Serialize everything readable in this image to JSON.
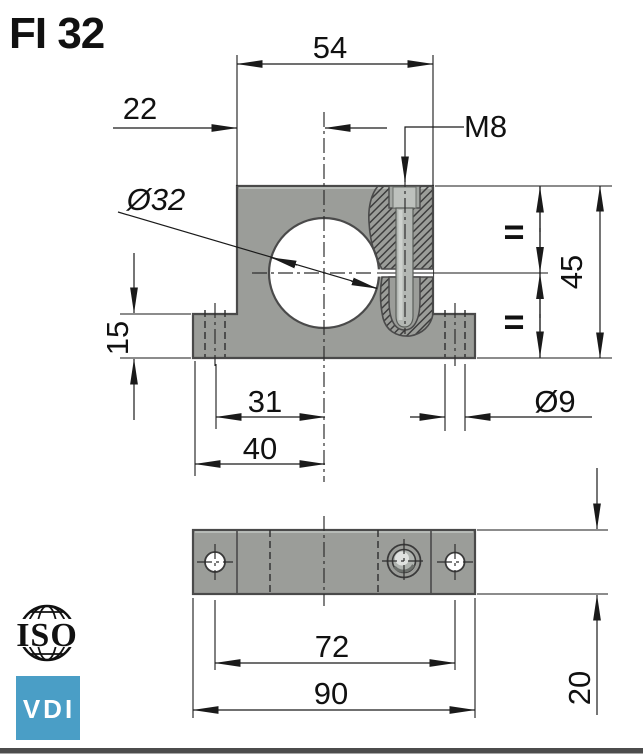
{
  "title": "FI 32",
  "front_view": {
    "width_top": "54",
    "center_offset": "22",
    "thread_label": "M8",
    "bore_label": "Ø32",
    "height_label": "45",
    "base_height_label": "15",
    "hole_center_label": "31",
    "hole_edge_label": "40",
    "hole_dia_label": "Ø9",
    "equal_top": "=",
    "equal_bottom": "="
  },
  "top_view": {
    "hole_spacing_label": "72",
    "overall_width_label": "90",
    "depth_label": "20"
  },
  "logos": {
    "iso_label": "ISO",
    "vdi_label": "VDI",
    "vdi_color": "#4A9EC6"
  },
  "colors": {
    "body_gray": "#9B9D99",
    "outline_gray": "#4A4A4A",
    "screw_gray": "#B3B7B3",
    "dim_line": "#1A1A1A",
    "bottom_bar": "#4C4C4C"
  }
}
